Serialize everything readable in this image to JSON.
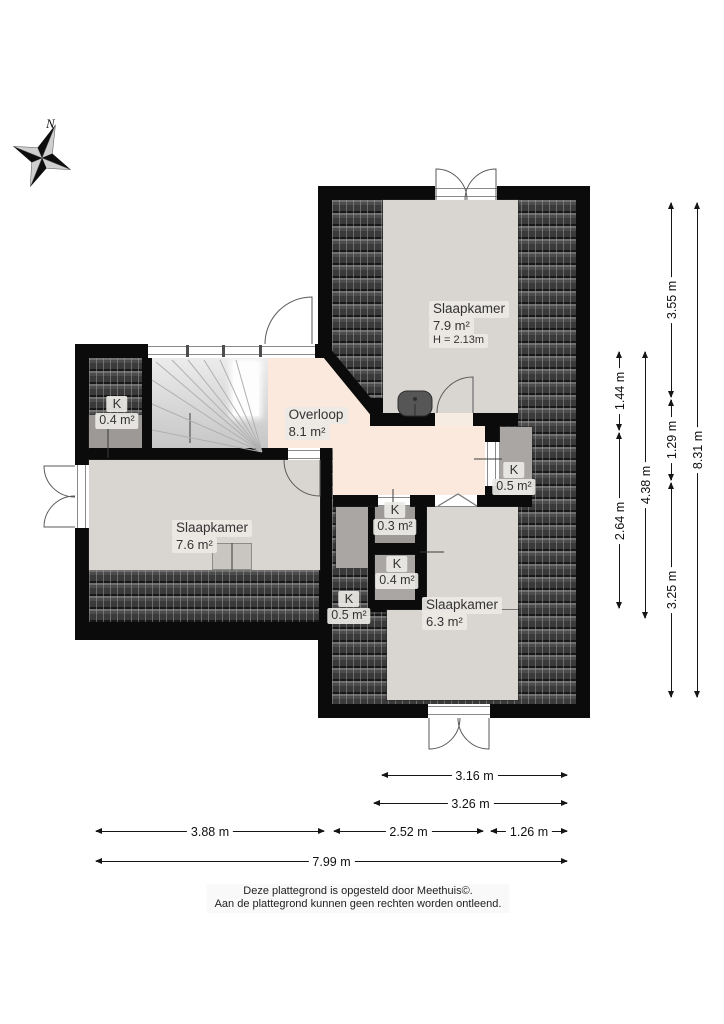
{
  "compass": {
    "north_label": "N"
  },
  "floorplan": {
    "rooms": [
      {
        "name": "Slaapkamer",
        "area": "7.9 m²",
        "extra": "H = 2.13m",
        "style": {
          "left": "469px",
          "top": "301px"
        }
      },
      {
        "name": "Overloop",
        "area": "8.1 m²",
        "extra": "",
        "style": {
          "left": "316px",
          "top": "407px"
        }
      },
      {
        "name": "Slaapkamer",
        "area": "7.6 m²",
        "extra": "",
        "style": {
          "left": "212px",
          "top": "520px"
        }
      },
      {
        "name": "Slaapkamer",
        "area": "6.3 m²",
        "extra": "",
        "style": {
          "left": "462px",
          "top": "597px"
        }
      }
    ],
    "closets": [
      {
        "k": "K",
        "area": "0.4 m²",
        "style": {
          "left": "117px",
          "top": "395px"
        }
      },
      {
        "k": "K",
        "area": "0.5 m²",
        "style": {
          "left": "514px",
          "top": "461px"
        }
      },
      {
        "k": "K",
        "area": "0.3 m²",
        "style": {
          "left": "395px",
          "top": "501px"
        }
      },
      {
        "k": "K",
        "area": "0.4 m²",
        "style": {
          "left": "397px",
          "top": "555px"
        }
      },
      {
        "k": "K",
        "area": "0.5 m²",
        "style": {
          "left": "349px",
          "top": "590px"
        }
      }
    ]
  },
  "dimensions": {
    "vertical": [
      {
        "label": "1.44 m",
        "style": {
          "left": "619px",
          "top": "352px",
          "height": "78px"
        }
      },
      {
        "label": "2.64 m",
        "style": {
          "left": "619px",
          "top": "433px",
          "height": "175px"
        }
      },
      {
        "label": "4.38 m",
        "style": {
          "left": "645px",
          "top": "352px",
          "height": "266px"
        }
      },
      {
        "label": "3.55 m",
        "style": {
          "left": "671px",
          "top": "203px",
          "height": "194px"
        }
      },
      {
        "label": "1.29 m",
        "style": {
          "left": "671px",
          "top": "400px",
          "height": "80px"
        }
      },
      {
        "label": "3.25 m",
        "style": {
          "left": "671px",
          "top": "483px",
          "height": "214px"
        }
      },
      {
        "label": "8.31 m",
        "style": {
          "left": "697px",
          "top": "203px",
          "height": "494px"
        }
      }
    ],
    "horizontal": [
      {
        "label": "3.16 m",
        "style": {
          "left": "382px",
          "top": "775px",
          "width": "185px"
        }
      },
      {
        "label": "3.26 m",
        "style": {
          "left": "374px",
          "top": "803px",
          "width": "193px"
        }
      },
      {
        "label": "3.88 m",
        "style": {
          "left": "96px",
          "top": "831px",
          "width": "228px"
        }
      },
      {
        "label": "2.52 m",
        "style": {
          "left": "334px",
          "top": "831px",
          "width": "149px"
        }
      },
      {
        "label": "1.26 m",
        "style": {
          "left": "491px",
          "top": "831px",
          "width": "76px"
        }
      },
      {
        "label": "7.99 m",
        "style": {
          "left": "96px",
          "top": "861px",
          "width": "471px"
        }
      }
    ]
  },
  "footer": {
    "line1": "Deze plattegrond is opgesteld door Meethuis©.",
    "line2": "Aan de plattegrond kunnen geen rechten worden ontleend."
  }
}
